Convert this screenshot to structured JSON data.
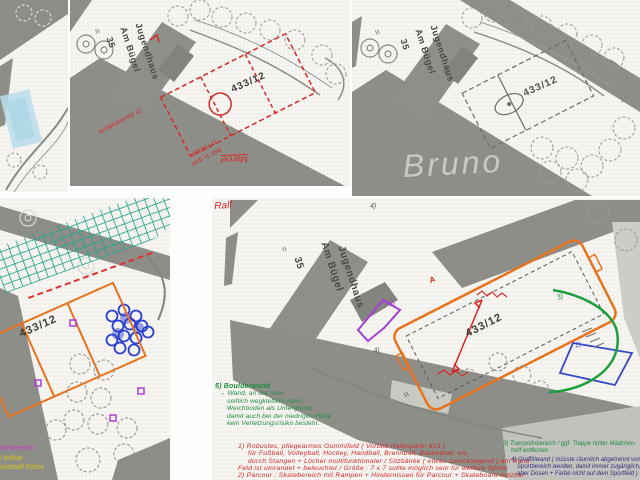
{
  "colors": {
    "road_gray": "#8e8e89",
    "paper": "#f6f5f1",
    "red_annotation": "#d42a2a",
    "green_annotation": "#1f8c3c",
    "orange_field": "#e8731e",
    "teal_grid": "#27a390",
    "blue_mark": "#3548c8",
    "purple_mark": "#a53fd6",
    "magenta_legend": "#c03fc0",
    "yellow_legend": "#cfc414",
    "pencil_gray": "#55524c",
    "highlight_blue": "#b9ddeb",
    "ink_blue": "#32327e"
  },
  "glyphs": {
    "equals": "="
  },
  "plans": {
    "top_middle": {
      "building": "Jugendhaus",
      "street": "Am Bügel",
      "street_no": "35",
      "parcel": "433/12",
      "note_basketball": "2x Basketballkorb",
      "note_field_1": "1x Fußball-",
      "note_field_2": "feld, 1x quer",
      "author": "Marcel"
    },
    "top_right": {
      "building": "Jugendhaus",
      "street": "Am Bügel",
      "street_no": "35",
      "parcel": "433/12",
      "author": "Bruno"
    },
    "bottom_left": {
      "parcel": "433/12",
      "legend_magenta": "olinbereich",
      "legend_yellow_1": "l teilbar",
      "legend_yellow_2": "sketball Körbe"
    },
    "bottom_right": {
      "author": "Ralf",
      "building": "Jugendhaus",
      "street": "Am Bügel",
      "street_no": "35",
      "parcel": "433/12",
      "marker_a": "A",
      "marker_2": "2)",
      "marker_3": "3)",
      "marker_4": "4)",
      "marker_5": "5)"
    }
  },
  "notes": {
    "item5": {
      "title": "5) Boulderwand",
      "lines": [
        "→ Wand, an der man",
        "seitlich wegklettern kann.",
        "Weichboden als Untergrund,",
        "damit auch bei der niedrigen Höhe",
        "kein Verletzungsrisiko besteht."
      ]
    },
    "item1": {
      "lines": [
        "1) Robustes, pflegearmes Gummifeld ( Vorbild Hafenpark! 623 )",
        "für Fußball, Volleyball, Hockey, Handball, Brennball, Basketball, etc.",
        "durch Stangen + Löcher multifunktionaler / Sitzbänke ( etwas zurückliegend ) am Rand",
        "Feld ist umrandet + beleuchtet / Größe : 7 x 7 sollte möglich sein für weitere Spiele"
      ]
    },
    "item2": {
      "line": "2) Parcour : Skatebereich mit Rampen + Hindernissen für Parcour + Skateboard nutzbar"
    },
    "item3": {
      "lines": [
        "3) Trampolinbereich / ggf. Treppe hinter Mädchen-",
        "treff entfernen"
      ]
    },
    "item4": {
      "lines": [
        "4) Graffitiwand ( müsste räumlich abgetrennt vom",
        "Sportbereich werden, damit immer zugänglich,",
        "aber Dosen + Farbe nicht auf dem Sportfeld )"
      ]
    }
  }
}
